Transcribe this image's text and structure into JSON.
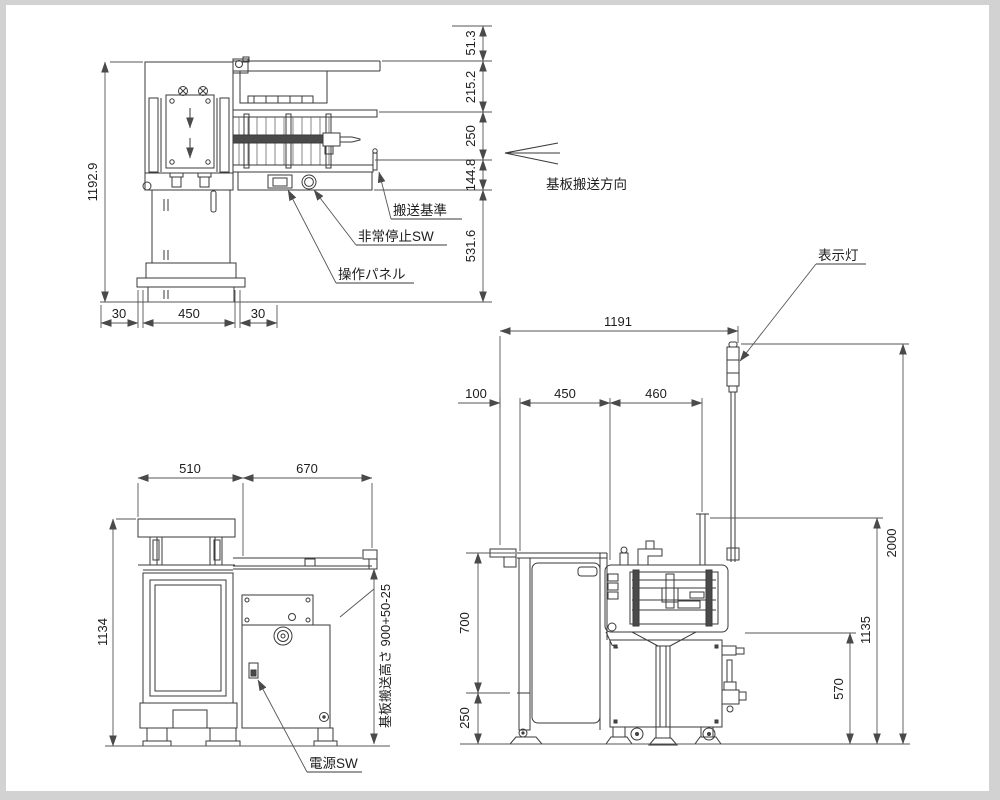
{
  "colors": {
    "frame": "#d2d2d2",
    "paper": "#ffffff",
    "machine_line": "#3a3a3a",
    "dimension_line": "#555555",
    "text": "#1d1d1d"
  },
  "views": {
    "upper": {
      "overall_height": "1192.9",
      "base_dims": {
        "left": "30",
        "center": "450",
        "right": "30"
      },
      "right_chain": {
        "d1": "51.3",
        "d2": "215.2",
        "d3": "250",
        "d4": "144.8",
        "d5": "531.6"
      },
      "callouts": {
        "transport_reference": "搬送基準",
        "emergency_stop": "非常停止SW",
        "operation_panel": "操作パネル"
      },
      "transport_direction": "基板搬送方向"
    },
    "front": {
      "top_dims": {
        "left": "510",
        "right": "670"
      },
      "overall_height": "1134",
      "transfer_height": "基板搬送高さ 900+50-25",
      "callouts": {
        "power_switch": "電源SW"
      }
    },
    "side": {
      "overall_width": "1191",
      "top_dims": {
        "d1": "100",
        "d2": "450",
        "d3": "460"
      },
      "left_dims": {
        "upper": "700",
        "lower": "250"
      },
      "right_dims": {
        "inner": "570",
        "middle": "1135",
        "outer": "2000"
      },
      "callouts": {
        "indicator_light": "表示灯"
      }
    }
  }
}
